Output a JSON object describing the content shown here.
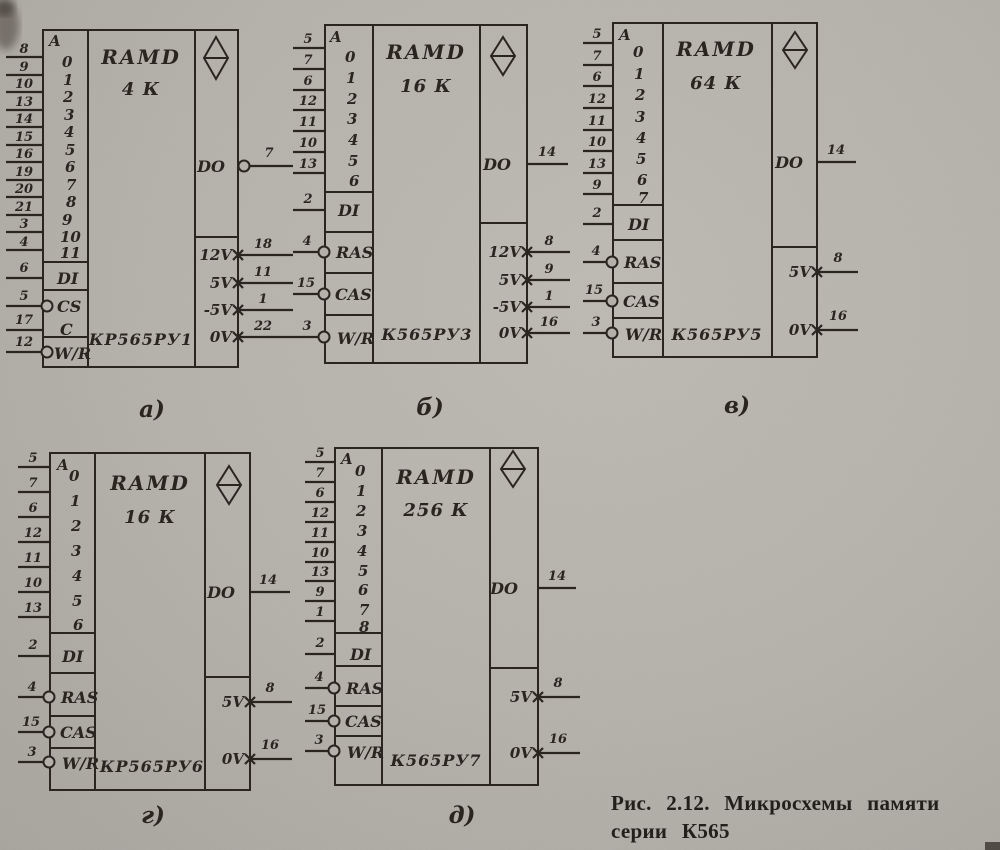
{
  "caption": {
    "line1": "Рис. 2.12. Микросхемы памяти",
    "line2": "серии К565"
  },
  "diagrams": [
    {
      "label": "а)",
      "func": "RAMD",
      "size": "4 К",
      "chip": "КР565РУ1",
      "addr_header": "A",
      "addr_bits": [
        "0",
        "1",
        "2",
        "3",
        "4",
        "5",
        "6",
        "7",
        "8",
        "9",
        "10",
        "11"
      ],
      "addr_pins": [
        "8",
        "9",
        "10",
        "13",
        "14",
        "15",
        "16",
        "19",
        "20",
        "21",
        "3",
        "4"
      ],
      "ctrl": [
        {
          "label": "DI",
          "pin": "6"
        },
        {
          "label": "CS",
          "pin": "5"
        },
        {
          "label": "C",
          "pin": "17"
        },
        {
          "label": "W/R",
          "pin": "12"
        }
      ],
      "out": {
        "label": "DO",
        "pin": "7"
      },
      "power": [
        {
          "label": "12V",
          "pin": "18"
        },
        {
          "label": "5V",
          "pin": "11"
        },
        {
          "label": "-5V",
          "pin": "1"
        },
        {
          "label": "0V",
          "pin": "22"
        }
      ]
    },
    {
      "label": "б)",
      "func": "RAMD",
      "size": "16 К",
      "chip": "К565РУ3",
      "addr_header": "A",
      "addr_bits": [
        "0",
        "1",
        "2",
        "3",
        "4",
        "5",
        "6"
      ],
      "addr_pins": [
        "5",
        "7",
        "6",
        "12",
        "11",
        "10",
        "13"
      ],
      "ctrl": [
        {
          "label": "DI",
          "pin": "2"
        },
        {
          "label": "RAS",
          "pin": "4"
        },
        {
          "label": "CAS",
          "pin": "15"
        },
        {
          "label": "W/R",
          "pin": "3"
        }
      ],
      "out": {
        "label": "DO",
        "pin": "14"
      },
      "power": [
        {
          "label": "12V",
          "pin": "8"
        },
        {
          "label": "5V",
          "pin": "9"
        },
        {
          "label": "-5V",
          "pin": "1"
        },
        {
          "label": "0V",
          "pin": "16"
        }
      ]
    },
    {
      "label": "в)",
      "func": "RAMD",
      "size": "64 К",
      "chip": "К565РУ5",
      "addr_header": "A",
      "addr_bits": [
        "0",
        "1",
        "2",
        "3",
        "4",
        "5",
        "6",
        "7"
      ],
      "addr_pins": [
        "5",
        "7",
        "6",
        "12",
        "11",
        "10",
        "13",
        "9"
      ],
      "ctrl": [
        {
          "label": "DI",
          "pin": "2"
        },
        {
          "label": "RAS",
          "pin": "4"
        },
        {
          "label": "CAS",
          "pin": "15"
        },
        {
          "label": "W/R",
          "pin": "3"
        }
      ],
      "out": {
        "label": "DO",
        "pin": "14"
      },
      "power": [
        {
          "label": "5V",
          "pin": "8"
        },
        {
          "label": "0V",
          "pin": "16"
        }
      ]
    },
    {
      "label": "г)",
      "func": "RAMD",
      "size": "16 К",
      "chip": "КР565РУ6",
      "addr_header": "A",
      "addr_bits": [
        "0",
        "1",
        "2",
        "3",
        "4",
        "5",
        "6"
      ],
      "addr_pins": [
        "5",
        "7",
        "6",
        "12",
        "11",
        "10",
        "13"
      ],
      "ctrl": [
        {
          "label": "DI",
          "pin": "2"
        },
        {
          "label": "RAS",
          "pin": "4"
        },
        {
          "label": "CAS",
          "pin": "15"
        },
        {
          "label": "W/R",
          "pin": "3"
        }
      ],
      "out": {
        "label": "DO",
        "pin": "14"
      },
      "power": [
        {
          "label": "5V",
          "pin": "8"
        },
        {
          "label": "0V",
          "pin": "16"
        }
      ]
    },
    {
      "label": "д)",
      "func": "RAMD",
      "size": "256 К",
      "chip": "К565РУ7",
      "addr_header": "A",
      "addr_bits": [
        "0",
        "1",
        "2",
        "3",
        "4",
        "5",
        "6",
        "7",
        "8"
      ],
      "addr_pins": [
        "5",
        "7",
        "6",
        "12",
        "11",
        "10",
        "13",
        "9",
        "1"
      ],
      "ctrl": [
        {
          "label": "DI",
          "pin": "2"
        },
        {
          "label": "RAS",
          "pin": "4"
        },
        {
          "label": "CAS",
          "pin": "15"
        },
        {
          "label": "W/R",
          "pin": "3"
        }
      ],
      "out": {
        "label": "DO",
        "pin": "14"
      },
      "power": [
        {
          "label": "5V",
          "pin": "8"
        },
        {
          "label": "0V",
          "pin": "16"
        }
      ]
    }
  ]
}
